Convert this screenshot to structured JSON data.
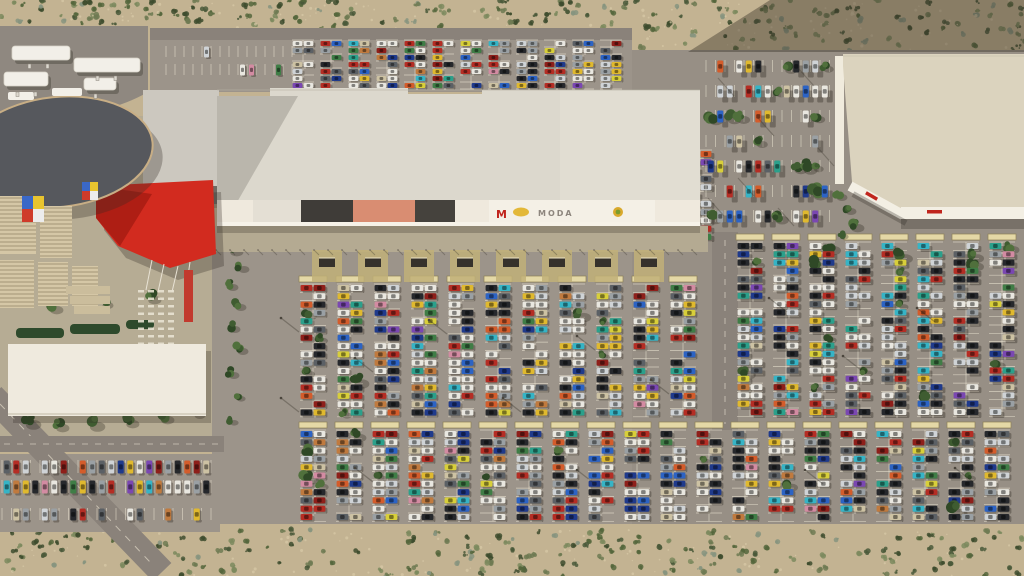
{
  "scene": {
    "description": "Aerial 3D render of a desert retail park: long strip mall with red entrance canopy, anchor store at right, gas station at top-left, and large parking lots filled with colorful cars",
    "signs": {
      "m_letter": "M",
      "moda": "MODA"
    },
    "palette": {
      "sand": "#c3b392",
      "speckle": "#d9cba8",
      "asphalt": "#9c948a",
      "asphaltEast": "#978f85",
      "road": "#8a827a",
      "gasPad": "#8f8880",
      "plaza": "#b6ac94",
      "stall": "#efe8d6",
      "shelter": "#e4d8a6",
      "shelterEdge": "#8d8157",
      "roof": "#dcd8cd",
      "roofWest": "#ccc8bf",
      "roofAnchor": "#dbd3be",
      "facadeWhite": "#f3efe4",
      "wallLight": "#f0ebdd",
      "oval": "#56585d",
      "ovalRim": "#c8ae85",
      "red": "#d22b1f",
      "redDark": "#a81c13",
      "canopyWhite": "#f2efe8",
      "promenade": "#b4aa92",
      "padYellow": "#c1b078",
      "corral": "#35312b",
      "hedge": "#2e4a2c",
      "white": "#efeade",
      "signRed": "#c0251d",
      "stripe1": "#d5c7a6",
      "stripe2": "#b3a585"
    },
    "shrubColors": [
      "#55663c",
      "#3e4c2e",
      "#6e7a52",
      "#87947f",
      "#4a593a",
      "#7d8a5e"
    ],
    "treeColors": [
      "#3f5c31",
      "#2f4826",
      "#50703c"
    ],
    "carColors": [
      [
        "#e9e7e0",
        30
      ],
      [
        "#cfd3d6",
        14
      ],
      [
        "#9aa0a4",
        12
      ],
      [
        "#5b6065",
        12
      ],
      [
        "#26282c",
        22
      ],
      [
        "#b52d24",
        14
      ],
      [
        "#8e1f1a",
        6
      ],
      [
        "#d45c2b",
        6
      ],
      [
        "#e0b92e",
        8
      ],
      [
        "#d8cf3a",
        4
      ],
      [
        "#3f7d46",
        6
      ],
      [
        "#2ba08b",
        5
      ],
      [
        "#36b4c6",
        8
      ],
      [
        "#2c63c4",
        10
      ],
      [
        "#1f3a8c",
        8
      ],
      [
        "#7a47b2",
        4
      ],
      [
        "#c07a3e",
        4
      ],
      [
        "#d38ba2",
        3
      ],
      [
        "#cdc2a3",
        6
      ]
    ],
    "desertRegions": [
      {
        "x": 0,
        "y": 0,
        "w": 150,
        "h": 28,
        "count": 46,
        "seed": 101
      },
      {
        "x": 150,
        "y": 0,
        "w": 488,
        "h": 28,
        "count": 120,
        "seed": 102
      },
      {
        "x": 638,
        "y": 0,
        "w": 386,
        "h": 50,
        "count": 150,
        "seed": 103
      },
      {
        "x": 0,
        "y": 530,
        "w": 1024,
        "h": 46,
        "count": 300,
        "seed": 104
      }
    ],
    "lots": [
      {
        "name": "top-strip-sparse",
        "kind": "rows",
        "x": 166,
        "y": 46,
        "w": 126,
        "rows": 2,
        "rowPitch": 18,
        "stallPitch": 9,
        "carW": 5,
        "carH": 11,
        "density": 0.22,
        "seed": 61,
        "shadow": [
          2,
          1.5
        ]
      },
      {
        "name": "top-strip-cluster",
        "kind": "columns",
        "x": 292,
        "y": 40,
        "cols": 12,
        "pitch": 28,
        "carLen": 11,
        "carW": 5,
        "rows": 7,
        "rowPitch": 7,
        "density": 0.72,
        "seed": 51,
        "shadow": [
          2,
          1.5
        ]
      },
      {
        "name": "east-road-column",
        "kind": "columns",
        "x": 688,
        "y": 150,
        "cols": 1,
        "pitch": 36,
        "carLen": 12,
        "carW": 6,
        "rows": 11,
        "rowPitch": 8.3,
        "density": 0.55,
        "seed": 41,
        "shadow": [
          3,
          2
        ]
      },
      {
        "name": "north-east-lot",
        "kind": "rows",
        "x": 706,
        "y": 60,
        "w": 126,
        "rows": 7,
        "rowPitch": 25,
        "stallPitch": 9.5,
        "carW": 6,
        "carH": 12,
        "density": 0.5,
        "treeChance": 0.14,
        "seed": 71,
        "shadow": [
          5,
          5
        ]
      },
      {
        "name": "main-lot-bank-a",
        "kind": "columns",
        "x": 300,
        "y": 284,
        "cols": 11,
        "pitch": 37,
        "carLen": 13,
        "carW": 6,
        "rows": 16,
        "rowPitch": 8.3,
        "density": 0.82,
        "treeChance": 0.03,
        "seed": 11,
        "shelters": true,
        "shadow": [
          2,
          2
        ]
      },
      {
        "name": "east-lot-bank-a",
        "kind": "columns",
        "x": 737,
        "y": 242,
        "cols": 8,
        "pitch": 36,
        "carLen": 13,
        "carW": 6,
        "rows": 21,
        "rowPitch": 8.3,
        "density": 0.75,
        "treeChance": 0.03,
        "seed": 21,
        "shelters": true,
        "shadow": [
          3,
          3
        ]
      },
      {
        "name": "south-bank-b",
        "kind": "columns",
        "x": 300,
        "y": 430,
        "cols": 20,
        "pitch": 36,
        "carLen": 13,
        "carW": 6,
        "rows": 11,
        "rowPitch": 8.3,
        "density": 0.8,
        "treeChance": 0.02,
        "seed": 31,
        "shelters": true,
        "shadow": [
          2,
          2
        ]
      },
      {
        "name": "southwest-lot-main",
        "kind": "rows",
        "x": 2,
        "y": 460,
        "w": 212,
        "rows": 2,
        "rowPitch": 20,
        "stallPitch": 9.5,
        "carW": 6,
        "carH": 13,
        "density": 0.92,
        "seed": 81,
        "shadow": [
          2,
          2
        ]
      },
      {
        "name": "southwest-lot-road-row",
        "kind": "rows",
        "x": 2,
        "y": 508,
        "w": 212,
        "rows": 1,
        "rowPitch": 18,
        "stallPitch": 9.5,
        "carW": 6,
        "carH": 12,
        "density": 0.5,
        "seed": 91,
        "shadow": [
          2,
          2
        ]
      }
    ],
    "facadePanels": [
      {
        "x": 217,
        "w": 36,
        "c": "#efe9dd"
      },
      {
        "x": 253,
        "w": 48,
        "c": "#e4dfd4"
      },
      {
        "x": 301,
        "w": 52,
        "c": "#3f3c38"
      },
      {
        "x": 353,
        "w": 62,
        "c": "#d98d72"
      },
      {
        "x": 415,
        "w": 40,
        "c": "#45423d"
      },
      {
        "x": 455,
        "w": 34,
        "c": "#efe9dd"
      },
      {
        "x": 489,
        "w": 108,
        "c": "#f4f0e6"
      },
      {
        "x": 597,
        "w": 58,
        "c": "#f4f0e6"
      },
      {
        "x": 655,
        "w": 45,
        "c": "#efe9dd"
      }
    ],
    "trees": [
      [
        232,
        248,
        6
      ],
      [
        240,
        266,
        5
      ],
      [
        229,
        284,
        5
      ],
      [
        237,
        304,
        5
      ],
      [
        231,
        326,
        5
      ],
      [
        239,
        348,
        5
      ],
      [
        230,
        372,
        5
      ],
      [
        238,
        396,
        4
      ],
      [
        231,
        420,
        4
      ],
      [
        377,
        241,
        7
      ],
      [
        627,
        236,
        8
      ],
      [
        650,
        244,
        5
      ],
      [
        838,
        194,
        5
      ],
      [
        847,
        208,
        5
      ],
      [
        853,
        224,
        6
      ],
      [
        841,
        234,
        4
      ],
      [
        28,
        420,
        7
      ],
      [
        58,
        424,
        6
      ],
      [
        92,
        422,
        7
      ],
      [
        128,
        420,
        6
      ],
      [
        163,
        416,
        6
      ],
      [
        196,
        412,
        5
      ],
      [
        150,
        296,
        6
      ],
      [
        104,
        302,
        5
      ],
      [
        52,
        306,
        6
      ]
    ],
    "hedges": [
      [
        16,
        328,
        48,
        10
      ],
      [
        70,
        324,
        50,
        10
      ],
      [
        126,
        320,
        28,
        9
      ]
    ],
    "steps": [
      [
        66,
        286,
        44,
        8
      ],
      [
        70,
        296,
        40,
        8
      ],
      [
        74,
        306,
        36,
        8
      ]
    ],
    "pergolas": [
      [
        0,
        196,
        36,
        58
      ],
      [
        40,
        206,
        32,
        52
      ],
      [
        0,
        260,
        34,
        48
      ],
      [
        38,
        262,
        30,
        44
      ],
      [
        72,
        266,
        26,
        40
      ]
    ],
    "billboards": [
      [
        22,
        196,
        22,
        26
      ],
      [
        82,
        182,
        16,
        18
      ]
    ],
    "billboardColors": [
      "#3a68c8",
      "#e8c42f",
      "#cf3b2a",
      "#ececec"
    ],
    "gasCanopies": [
      [
        12,
        46,
        58,
        14
      ],
      [
        74,
        58,
        66,
        14
      ],
      [
        4,
        72,
        44,
        14
      ],
      [
        84,
        78,
        32,
        12
      ]
    ],
    "gasPumps": [
      [
        28,
        64
      ],
      [
        46,
        64
      ],
      [
        96,
        76
      ],
      [
        114,
        76
      ],
      [
        16,
        92
      ],
      [
        34,
        92
      ],
      [
        94,
        94
      ]
    ],
    "northBits": [
      [
        8,
        92,
        26,
        8
      ],
      [
        52,
        88,
        30,
        8
      ]
    ],
    "corralXs": [
      312,
      358,
      404,
      450,
      496,
      542,
      588,
      634
    ],
    "streaks": [
      [
        718,
        78
      ],
      [
        758,
        118
      ],
      [
        798,
        68
      ],
      [
        738,
        178
      ],
      [
        818,
        148
      ],
      [
        708,
        198
      ],
      [
        778,
        208
      ]
    ],
    "poles": [
      [
        281,
        318
      ],
      [
        281,
        398
      ],
      [
        355,
        358
      ],
      [
        429,
        320
      ],
      [
        503,
        398
      ],
      [
        577,
        336
      ],
      [
        651,
        380
      ],
      [
        769,
        298
      ],
      [
        843,
        356
      ],
      [
        917,
        308
      ],
      [
        355,
        468
      ],
      [
        577,
        470
      ],
      [
        805,
        470
      ],
      [
        955,
        468
      ]
    ],
    "marketStalls": {
      "x": 138,
      "y": 290,
      "cols": 4,
      "rows": 8,
      "dx": 10,
      "dy": 7.5,
      "w": 6,
      "h": 2.5
    }
  }
}
